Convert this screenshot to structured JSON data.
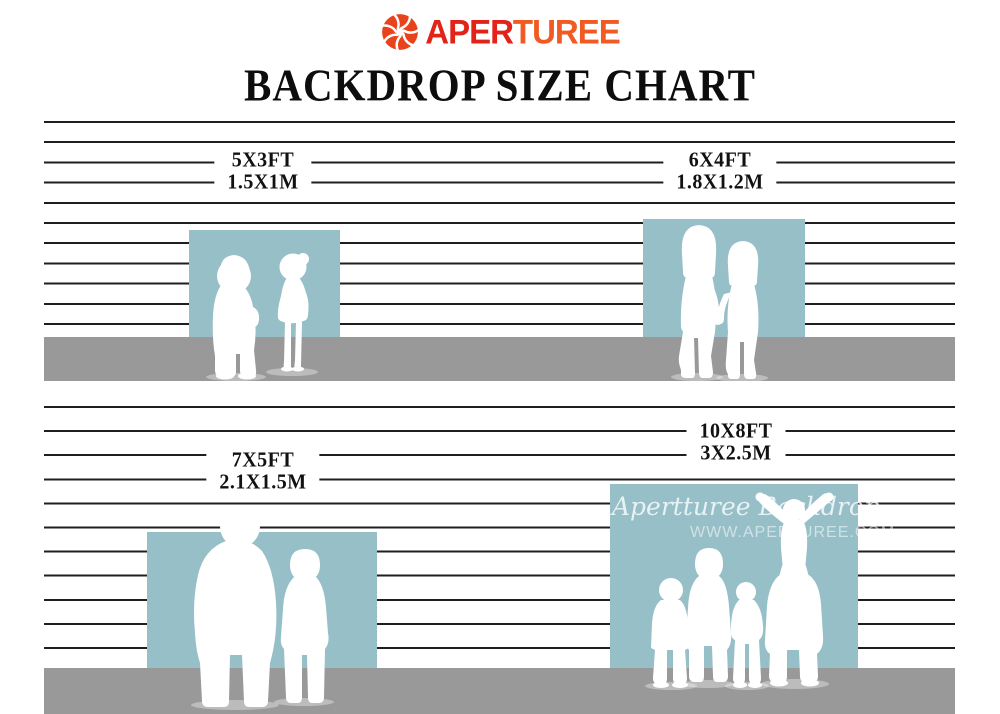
{
  "header": {
    "logo": {
      "icon": "aperture-icon",
      "text_red": "APER",
      "text_orange": "TUREE"
    },
    "title": "BACKDROP SIZE CHART"
  },
  "colors": {
    "backdrop_teal": "#96bfc8",
    "floor_gray": "#999999",
    "wall_line": "#1f1f1f",
    "logo_red": "#e2231a",
    "logo_orange": "#f15a22",
    "logo_icon": "#e8431c"
  },
  "backdrops": [
    {
      "name": "backdrop-5x3",
      "size_ft": "5X3FT",
      "size_m": "1.5X1M",
      "figures_icon": "two-toddlers-silhouette"
    },
    {
      "name": "backdrop-6x4",
      "size_ft": "6X4FT",
      "size_m": "1.8X1.2M",
      "figures_icon": "two-girls-holding-hands-silhouette"
    },
    {
      "name": "backdrop-7x5",
      "size_ft": "7X5FT",
      "size_m": "2.1X1.5M",
      "figures_icon": "adult-and-child-silhouette"
    },
    {
      "name": "backdrop-10x8",
      "size_ft": "10X8FT",
      "size_m": "3X2.5M",
      "figures_icon": "family-of-five-silhouette"
    }
  ],
  "watermark": {
    "script_text": "Apertturee Backdrop",
    "url_text": "WWW.APERTUREE.COM"
  }
}
